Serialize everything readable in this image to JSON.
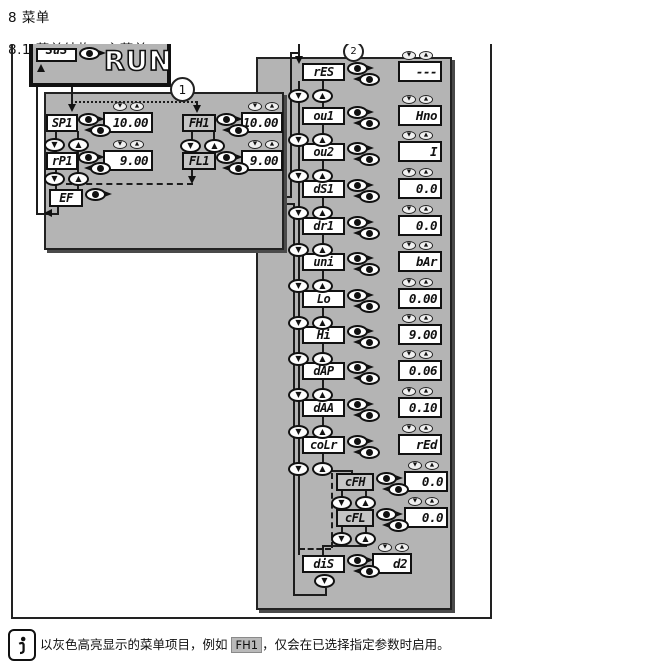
{
  "headings": {
    "chapter": "8 菜单",
    "section": "8.1 菜单结构：主菜单"
  },
  "figure": {
    "run_box": {
      "display_value": "SuS",
      "mode_label": "RUN"
    },
    "callouts": {
      "left": "1",
      "right": "2"
    },
    "colors": {
      "panel_gray": "#b4b4b4",
      "highlight_gray": "#c6c6c6",
      "display_white": "#ffffff",
      "line_black": "#1c1c1c"
    },
    "icons": {
      "mode_enter": "mode-enter-button",
      "up": "up-button",
      "down": "down-button"
    },
    "left_menu": {
      "rows": [
        {
          "label": "SP1",
          "value": "10.00",
          "highlighted": false
        },
        {
          "label": "FH1",
          "value": "10.00",
          "highlighted": true
        },
        {
          "label": "rP1",
          "value": "9.00",
          "highlighted": false
        },
        {
          "label": "FL1",
          "value": "9.00",
          "highlighted": true
        },
        {
          "label": "EF",
          "value": "",
          "highlighted": false
        }
      ]
    },
    "main_menu": {
      "rows": [
        {
          "label": "rES",
          "value": "---",
          "highlighted": false
        },
        {
          "label": "ou1",
          "value": "Hno",
          "highlighted": false
        },
        {
          "label": "ou2",
          "value": "I",
          "highlighted": false
        },
        {
          "label": "dS1",
          "value": "0.0",
          "highlighted": false
        },
        {
          "label": "dr1",
          "value": "0.0",
          "highlighted": false
        },
        {
          "label": "uni",
          "value": "bAr",
          "highlighted": false
        },
        {
          "label": "Lo",
          "value": "0.00",
          "highlighted": false
        },
        {
          "label": "Hi",
          "value": "9.00",
          "highlighted": false
        },
        {
          "label": "dAP",
          "value": "0.06",
          "highlighted": false
        },
        {
          "label": "dAA",
          "value": "0.10",
          "highlighted": false
        },
        {
          "label": "coLr",
          "value": "rEd",
          "highlighted": false
        },
        {
          "label": "cFH",
          "value": "0.0",
          "highlighted": true
        },
        {
          "label": "cFL",
          "value": "0.0",
          "highlighted": true
        },
        {
          "label": "diS",
          "value": "d2",
          "highlighted": false
        }
      ]
    }
  },
  "note": {
    "before": "以灰色高亮显示的菜单项目，例如 ",
    "highlight": "FH1",
    "after": "，仅会在已选择指定参数时启用。"
  }
}
